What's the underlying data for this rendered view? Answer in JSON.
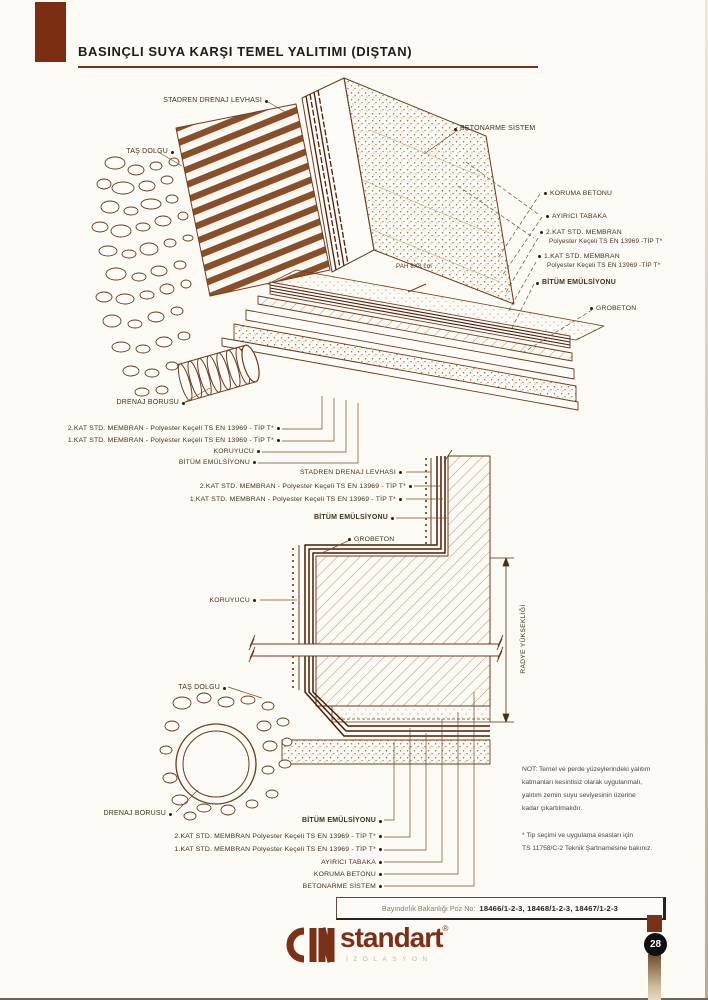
{
  "header": {
    "title": "BASINÇLI SUYA KARŞI TEMEL YALITIMI (DIŞTAN)"
  },
  "upper": {
    "stadren": "STADREN DRENAJ LEVHASI",
    "tas_dolgu": "TAŞ DOLGU",
    "betonarme": "BETONARME SİSTEM",
    "koruma_betonu": "KORUMA BETONU",
    "ayirici_tabaka": "AYIRICI TABAKA",
    "kat2": "2.KAT STD. MEMBRAN",
    "kat2_sub": "Polyester Keçeli TS EN 13969 -TİP T*",
    "kat1": "1.KAT STD. MEMBRAN",
    "kat1_sub": "Polyester Keçeli TS EN 13969 -TİP T*",
    "bitum_emulsiyonu": "BİTÜM EMÜLSİYONU",
    "grobeton": "GROBETON",
    "pah": "PAH 8X8 cm",
    "drenaj_borusu": "DRENAJ BORUSU",
    "kat2_long": "2.KAT STD. MEMBRAN - Polyester Keçeli TS EN 13969 - TİP T*",
    "kat1_long": "1.KAT STD. MEMBRAN - Polyester Keçeli TS EN 13969 - TİP T*",
    "koruyucu": "KORUYUCU",
    "bitum_emulsiyonu2": "BİTÜM EMÜLSİYONU"
  },
  "lower": {
    "stadren": "STADREN DRENAJ LEVHASI",
    "kat2_long": "2.KAT STD. MEMBRAN - Polyester Keçeli TS EN 13969 - TİP T*",
    "kat1_long": "1.KAT STD. MEMBRAN - Polyester Keçeli TS EN 13969 - TİP T*",
    "bitum_emulsiyonu": "BİTÜM EMÜLSİYONU",
    "grobeton": "GROBETON",
    "koruyucu": "KORUYUCU",
    "tas_dolgu": "TAŞ DOLGU",
    "drenaj_borusu": "DRENAJ BORUSU",
    "bitum_emulsiyonu2": "BİTÜM EMÜLSİYONU",
    "kat2_long2": "2.KAT STD. MEMBRAN Polyester Keçeli TS EN 13969 - TİP T*",
    "kat1_long2": "1.KAT STD. MEMBRAN Polyester Keçeli TS EN 13969 - TİP T*",
    "ayirici_tabaka": "AYIRICI TABAKA",
    "koruma_betonu": "KORUMA BETONU",
    "betonarme": "BETONARME SİSTEM",
    "radye": "RADYE YÜKSEKLİĞİ"
  },
  "notes": {
    "note1_lines": [
      "NOT: Temel ve perde yüzeylerindeki yalıtım",
      "katmanları kesintisiz olarak uygulanmalı,",
      "yalıtım zemin suyu seviyesinin üzerine",
      "kadar çıkartılmalıdır."
    ],
    "note2_lines": [
      "* Tip seçimi ve uygulama esasları için",
      "TS 11758/C-2 Teknik Şartnamesine bakınız."
    ]
  },
  "footer": {
    "poz_label": "Bayındırlık Bakanlığı Poz No:",
    "poz_numbers": "18466/1-2-3, 18468/1-2-3, 18467/1-2-3",
    "brand": "standart",
    "brand_reg": "®",
    "brand_sub": "İZOLASYON",
    "page_number": "28"
  },
  "colors": {
    "accent_brown": "#7b2d12",
    "ink_brown": "#46301c",
    "line_brown": "#6b3b1e",
    "page_bg": "#fbfaf5"
  }
}
